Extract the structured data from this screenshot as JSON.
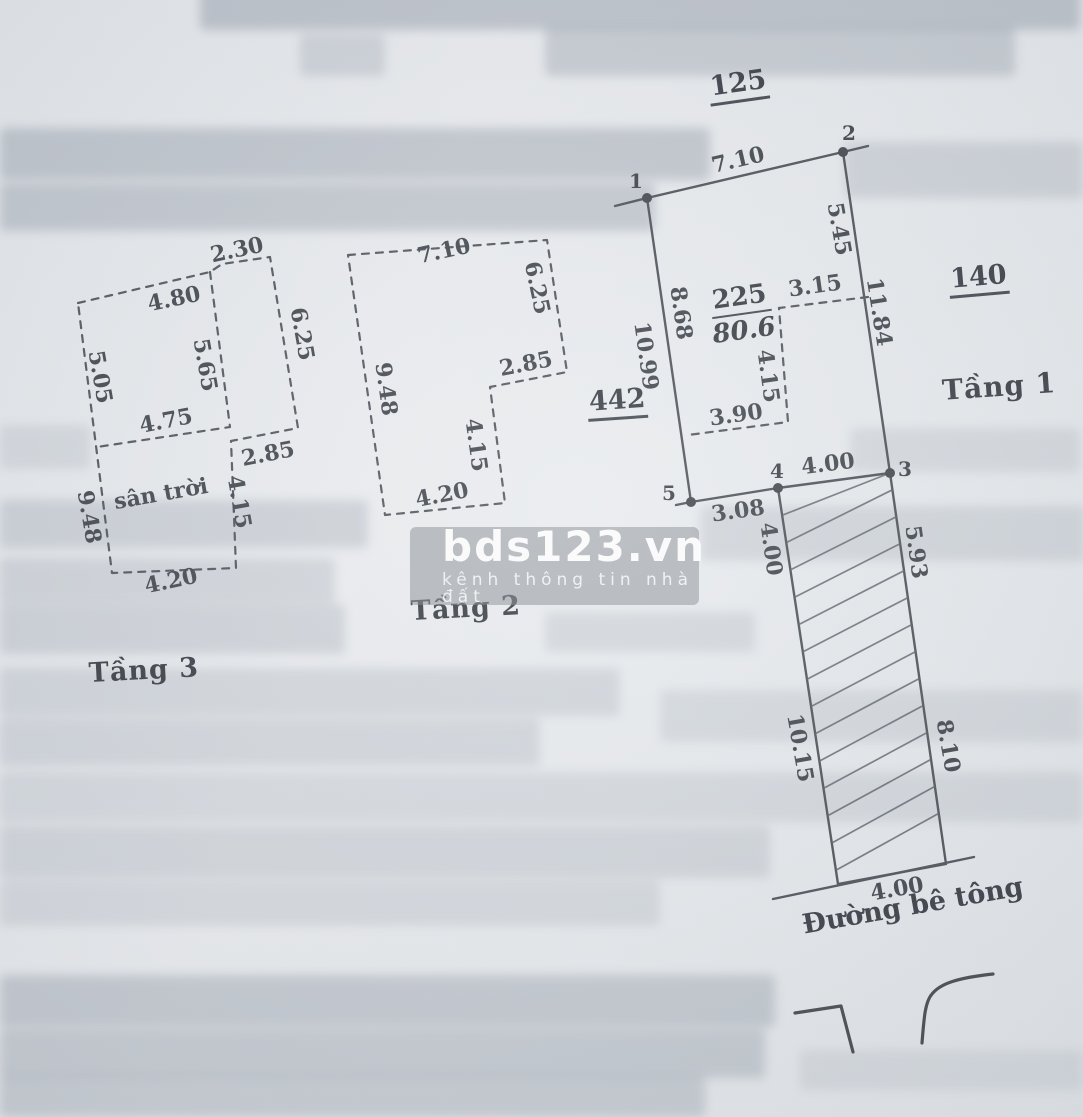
{
  "document": {
    "type": "scanned cadastral sketch page",
    "ink_color": "#3d424a",
    "paper_color": "#e6e9ec"
  },
  "watermark": {
    "brand": "bds123.vn",
    "tagline": "kênh thông tin nhà đất"
  },
  "road": {
    "label": "Đường bê tông"
  },
  "adjacent_lot_numbers": {
    "top": "125",
    "right": "140",
    "left": "442"
  },
  "parcel": {
    "number": "225",
    "area": "80.6"
  },
  "corner_points": [
    {
      "text": "1",
      "x": 636,
      "y": 181
    },
    {
      "text": "2",
      "x": 849,
      "y": 133
    },
    {
      "text": "3",
      "x": 905,
      "y": 469
    },
    {
      "text": "4",
      "x": 777,
      "y": 471
    },
    {
      "text": "5",
      "x": 669,
      "y": 493
    }
  ],
  "floors": {
    "tang1": {
      "label": "Tầng 1",
      "measurements": [
        {
          "text": "7.10",
          "x": 738,
          "y": 160,
          "r": -13
        },
        {
          "text": "5.45",
          "x": 839,
          "y": 229,
          "r": 80
        },
        {
          "text": "11.84",
          "x": 879,
          "y": 312,
          "r": 81
        },
        {
          "text": "8.68",
          "x": 681,
          "y": 313,
          "r": 82
        },
        {
          "text": "10.99",
          "x": 646,
          "y": 356,
          "r": 82
        },
        {
          "text": "3.15",
          "x": 815,
          "y": 286,
          "r": -8
        },
        {
          "text": "4.15",
          "x": 768,
          "y": 376,
          "r": 82
        },
        {
          "text": "3.90",
          "x": 736,
          "y": 415,
          "r": -8
        },
        {
          "text": "4.00",
          "x": 828,
          "y": 464,
          "r": -7
        },
        {
          "text": "3.08",
          "x": 738,
          "y": 511,
          "r": -8
        },
        {
          "text": "4.00",
          "x": 771,
          "y": 549,
          "r": 82
        },
        {
          "text": "5.93",
          "x": 916,
          "y": 552,
          "r": 82
        },
        {
          "text": "10.15",
          "x": 800,
          "y": 748,
          "r": 80
        },
        {
          "text": "8.10",
          "x": 948,
          "y": 746,
          "r": 80
        },
        {
          "text": "4.00",
          "x": 897,
          "y": 889,
          "r": -10
        }
      ]
    },
    "tang2": {
      "label": "Tầng 2",
      "measurements": [
        {
          "text": "7.10",
          "x": 444,
          "y": 251,
          "r": -12
        },
        {
          "text": "6.25",
          "x": 537,
          "y": 288,
          "r": 78
        },
        {
          "text": "2.85",
          "x": 526,
          "y": 364,
          "r": -11
        },
        {
          "text": "4.15",
          "x": 476,
          "y": 445,
          "r": 82
        },
        {
          "text": "4.20",
          "x": 442,
          "y": 495,
          "r": -11
        },
        {
          "text": "9.48",
          "x": 386,
          "y": 389,
          "r": 82
        }
      ]
    },
    "tang3": {
      "label": "Tầng 3",
      "terrace_label": "sân trời",
      "measurements": [
        {
          "text": "2.30",
          "x": 237,
          "y": 250,
          "r": -12
        },
        {
          "text": "4.80",
          "x": 174,
          "y": 299,
          "r": -12
        },
        {
          "text": "6.25",
          "x": 302,
          "y": 334,
          "r": 80
        },
        {
          "text": "5.05",
          "x": 100,
          "y": 377,
          "r": 80
        },
        {
          "text": "5.65",
          "x": 205,
          "y": 365,
          "r": 80
        },
        {
          "text": "4.75",
          "x": 166,
          "y": 421,
          "r": -11
        },
        {
          "text": "2.85",
          "x": 268,
          "y": 454,
          "r": -11
        },
        {
          "text": "4.15",
          "x": 239,
          "y": 502,
          "r": 80
        },
        {
          "text": "9.48",
          "x": 89,
          "y": 517,
          "r": 80
        },
        {
          "text": "sân trời",
          "x": 161,
          "y": 494,
          "r": -10
        },
        {
          "text": "4.20",
          "x": 171,
          "y": 581,
          "r": -12
        }
      ]
    }
  }
}
